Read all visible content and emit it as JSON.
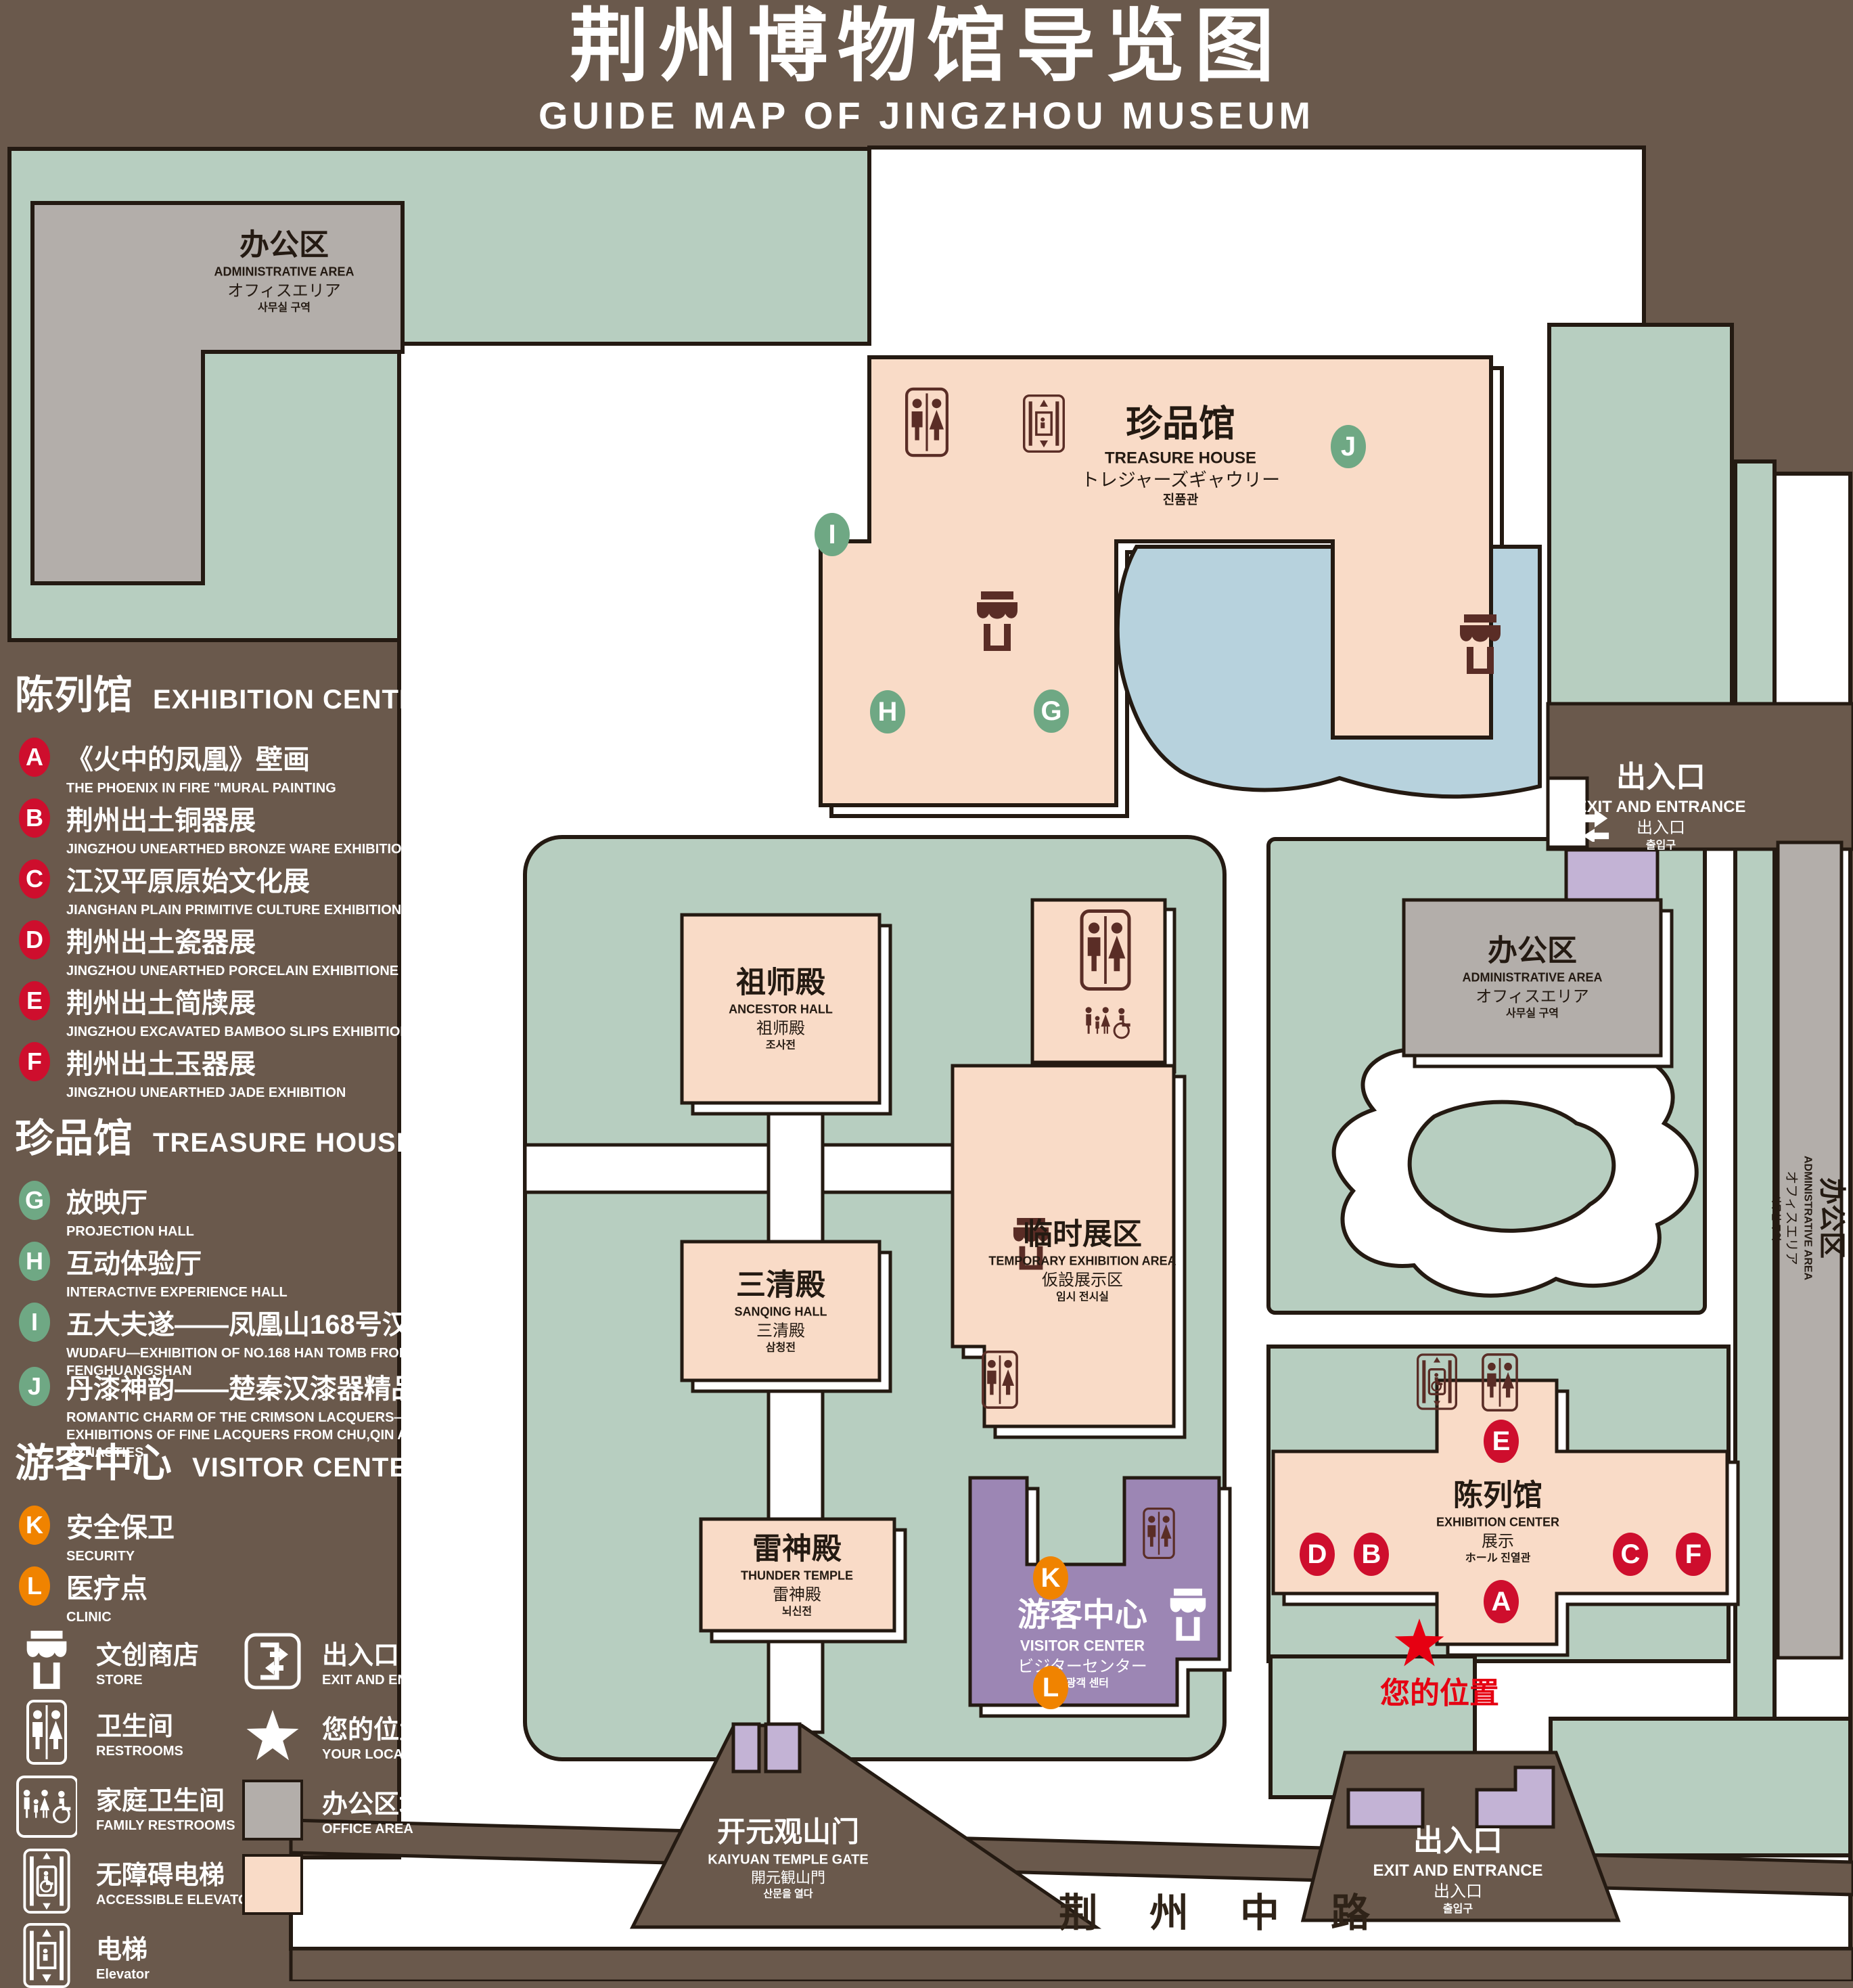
{
  "title": {
    "zh": "荆州博物馆导览图",
    "en": "GUIDE MAP OF JINGZHOU MUSEUM"
  },
  "colors": {
    "background": "#6a594c",
    "map_green": "#b7cec0",
    "display_area": "#f9dbc7",
    "office_area": "#b3aeaa",
    "visitor_center": "#9c86b4",
    "gate_purple": "#c3b3d5",
    "pond": "#b7d2dd",
    "line": "#241a12",
    "marker_red": "#ce0e2d",
    "marker_green": "#6fa884",
    "marker_orange": "#f08300",
    "location_red": "#e60012",
    "icon_maroon": "#5a2d26"
  },
  "legend": {
    "sections": [
      {
        "zh": "陈列馆",
        "en": "EXHIBITION CENTER",
        "items": [
          {
            "key": "A",
            "zh": "《火中的凤凰》壁画",
            "en": "THE PHOENIX IN FIRE \"MURAL PAINTING",
            "floor": "1F"
          },
          {
            "key": "B",
            "zh": "荆州出土铜器展",
            "en": "JINGZHOU UNEARTHED BRONZE WARE EXHIBITION",
            "floor": "1F"
          },
          {
            "key": "C",
            "zh": "江汉平原原始文化展",
            "en": "JIANGHAN PLAIN PRIMITIVE CULTURE EXHIBITION",
            "floor": "1F"
          },
          {
            "key": "D",
            "zh": "荆州出土瓷器展",
            "en": "JINGZHOU UNEARTHED PORCELAIN EXHIBITIONE",
            "floor": "2F"
          },
          {
            "key": "E",
            "zh": "荆州出土简牍展",
            "en": "JINGZHOU EXCAVATED BAMBOO SLIPS EXHIBITION",
            "floor": "2F"
          },
          {
            "key": "F",
            "zh": "荆州出土玉器展",
            "en": "JINGZHOU UNEARTHED JADE EXHIBITION",
            "floor": "2F"
          }
        ]
      },
      {
        "zh": "珍品馆",
        "en": "TREASURE HOUSE",
        "items": [
          {
            "key": "G",
            "zh": "放映厅",
            "en": "PROJECTION HALL",
            "floor": "1F"
          },
          {
            "key": "H",
            "zh": "互动体验厅",
            "en": "INTERACTIVE EXPERIENCE HALL",
            "floor": "1F"
          },
          {
            "key": "I",
            "zh": "五大夫遂——凤凰山168号汉墓展",
            "en": "WUDAFU—EXHIBITION OF NO.168 HAN TOMB FROM FENGHUANGSHAN",
            "floor": "2F"
          },
          {
            "key": "J",
            "zh": "丹漆神韵——楚秦汉漆器精品展",
            "en": "ROMANTIC CHARM OF THE CRIMSON LACQUERS—EXHIBITIONS OF FINE LACQUERS FROM CHU,QIN AND HAN DYNASTIES",
            "floor": "1-2F"
          }
        ]
      },
      {
        "zh": "游客中心",
        "en": "VISITOR CENTER",
        "items": [
          {
            "key": "K",
            "zh": "安全保卫",
            "en": "SECURITY",
            "floor": "1F"
          },
          {
            "key": "L",
            "zh": "医疗点",
            "en": "CLINIC",
            "floor": "1F"
          }
        ]
      }
    ],
    "symbols": [
      {
        "zh": "文创商店",
        "en": "STORE"
      },
      {
        "zh": "卫生间",
        "en": "RESTROOMS"
      },
      {
        "zh": "家庭卫生间",
        "en": "FAMILY RESTROOMS"
      },
      {
        "zh": "无障碍电梯",
        "en": "ACCESSIBLE ELEVATOR"
      },
      {
        "zh": "电梯",
        "en": "Elevator"
      },
      {
        "zh": "出入口",
        "en": "EXIT AND ENTRANCE"
      },
      {
        "zh": "您的位置",
        "en": "YOUR LOCATION"
      },
      {
        "zh": "办公区域",
        "en": "OFFICE AREA"
      },
      {
        "zh": "展示区域",
        "en": "DISPLAY AREA"
      }
    ]
  },
  "map": {
    "buildings": {
      "admin": {
        "zh": "办公区",
        "en": "ADMINISTRATIVE AREA",
        "ja": "オフィスエリア",
        "ko": "사무실 구역"
      },
      "treasure_house": {
        "zh": "珍品馆",
        "en": "TREASURE HOUSE",
        "ja": "トレジャーズギャウリー",
        "ko": "진품관"
      },
      "ancestor_hall": {
        "zh": "祖师殿",
        "en": "ANCESTOR HALL",
        "ja": "祖师殿",
        "ko": "조사전"
      },
      "temporary_exhibition": {
        "zh": "临时展区",
        "en": "TEMPORARY EXHIBITION AREA",
        "ja": "仮設展示区",
        "ko": "임시 전시실"
      },
      "sanqing_hall": {
        "zh": "三清殿",
        "en": "SANQING HALL",
        "ja": "三清殿",
        "ko": "삼청전"
      },
      "thunder_temple": {
        "zh": "雷神殿",
        "en": "THUNDER TEMPLE",
        "ja": "雷神殿",
        "ko": "뇌신전"
      },
      "visitor_center": {
        "zh": "游客中心",
        "en": "VISITOR CENTER",
        "ja": "ビジターセンター",
        "ko": "관광객 센터"
      },
      "exhibition_center": {
        "zh": "陈列馆",
        "en": "EXHIBITION CENTER",
        "ja": "展示",
        "ko": "ホール 진열관"
      },
      "kaiyuan_gate": {
        "zh": "开元观山门",
        "en": "KAIYUAN TEMPLE GATE",
        "ja": "開元観山門",
        "ko": "산문을 열다"
      },
      "exit": {
        "zh": "出入口",
        "en": "EXIT AND ENTRANCE",
        "ja": "出入口",
        "ko": "출입구"
      }
    },
    "your_location": "您的位置",
    "road": "荆 州 中 路"
  }
}
